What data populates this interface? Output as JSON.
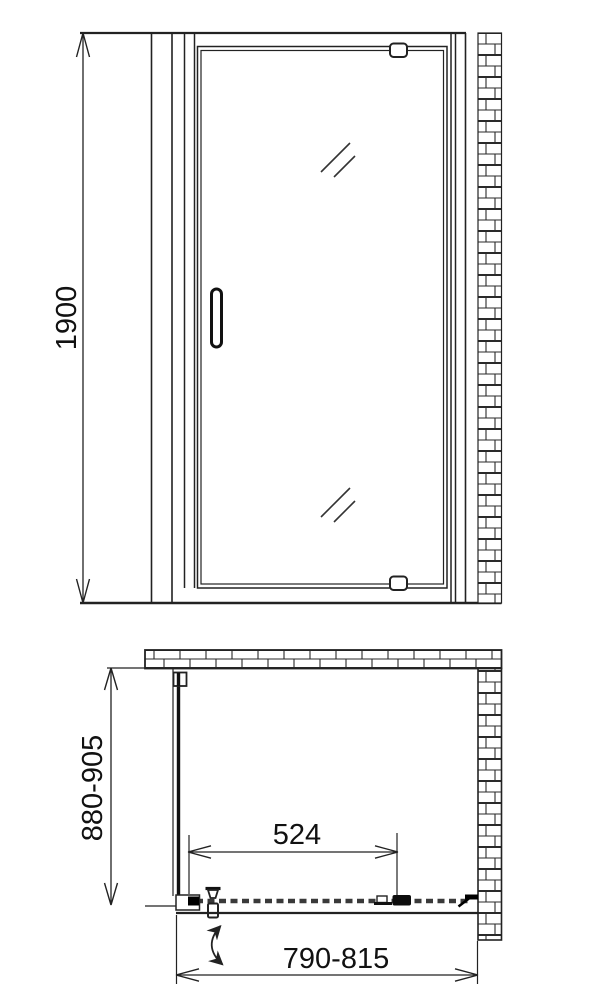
{
  "page": {
    "background_color": "#ffffff",
    "line_color": "#222222",
    "text_color": "#111111"
  },
  "drawing": {
    "type": "shower-door-technical-drawing",
    "elevation": {
      "height_label": "1900"
    },
    "plan": {
      "depth_label": "880-905",
      "interior_width_label": "524",
      "overall_width_label": "790-815"
    }
  }
}
